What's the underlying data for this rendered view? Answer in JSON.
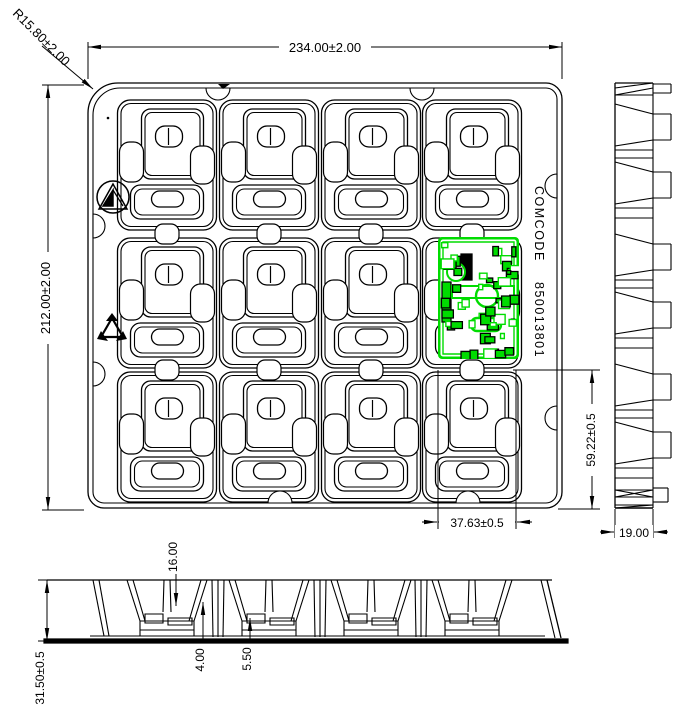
{
  "title": "Thermoformed tray technical drawing",
  "colors": {
    "line": "#000000",
    "background": "#ffffff",
    "pcb_green": "#00dc00"
  },
  "tray": {
    "grid": {
      "rows": 3,
      "cols": 4
    },
    "pcb_pocket": {
      "row": 2,
      "col": 4
    }
  },
  "labels": {
    "comcode": "COMCODE",
    "comcode_number": "850013801"
  },
  "dimensions": {
    "overall_width": "234.00±2.00",
    "overall_height": "212.00±2.00",
    "corner_radius": "R15.80±2.00",
    "pocket_width": "37.63±0.5",
    "pocket_height": "59.22±0.5",
    "side_view_width": "19.00",
    "overall_thickness": "31.50±0.5",
    "pocket_depth": "16.00",
    "step_a": "4.00",
    "step_b": "5.50"
  }
}
